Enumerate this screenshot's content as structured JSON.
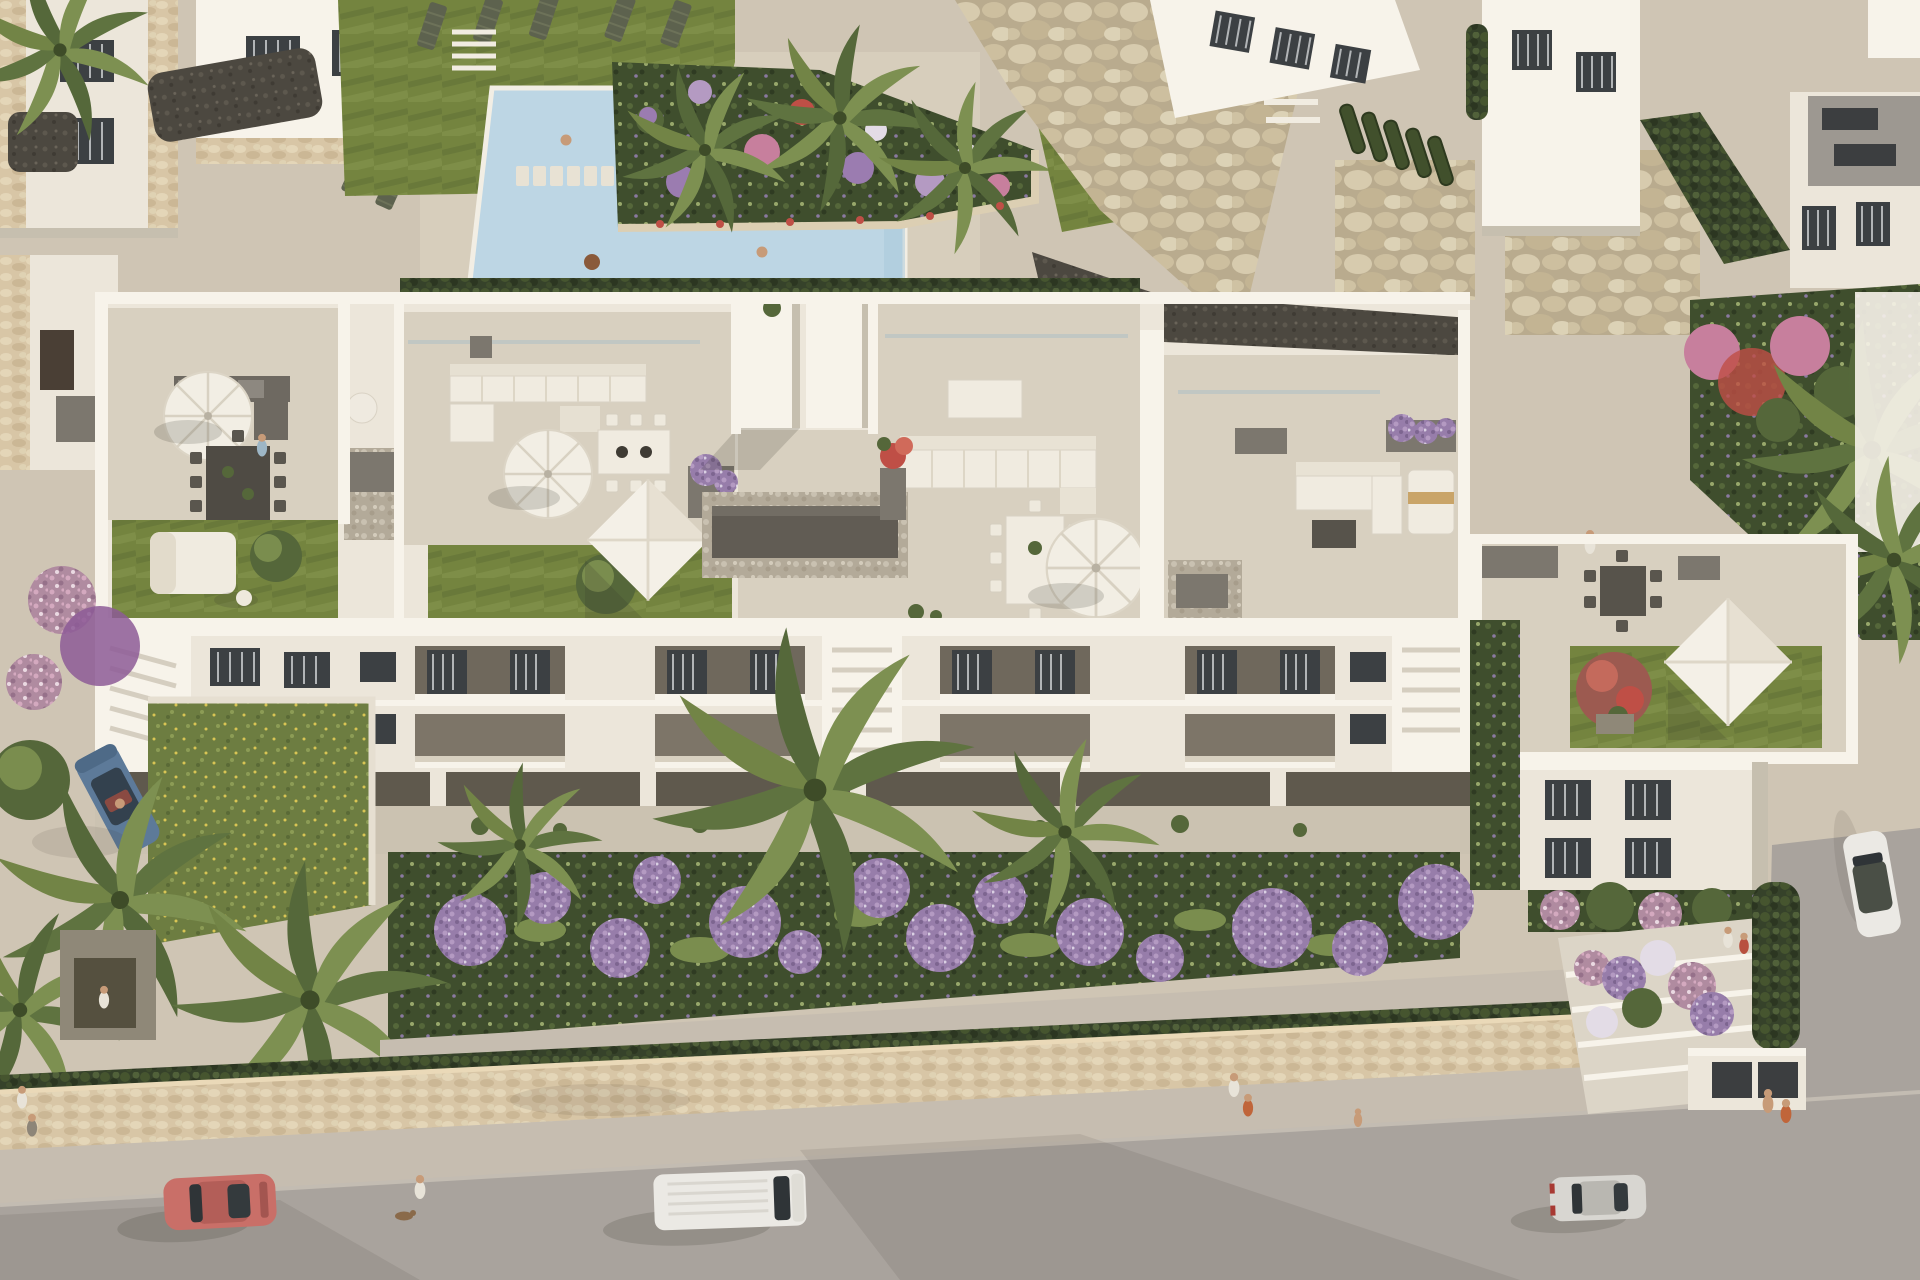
{
  "meta": {
    "label": "Aerial 3D render of a white Mediterranean apartment complex with rooftop terraces, communal pool, gardens and a street with cars"
  },
  "palette": {
    "plaza": "#cfc5b4",
    "plazaShade": "#c1b6a4",
    "tile": "#d8d0c0",
    "tileShade": "#cbc2b1",
    "whiteHi": "#f7f3ea",
    "whiteMid": "#ece6da",
    "whiteLo": "#dcd5c7",
    "wallShade": "#c6bfaf",
    "street": "#a9a39d",
    "sidewalk": "#c6bdb0",
    "stoneWall": "#d2c0a0",
    "pool": "#bdd6e4",
    "poolDeep": "#a8c8da",
    "lawn": "#74843f",
    "lawnDark": "#5d6e33",
    "vegDark": "#39452a",
    "vegMid": "#55673a",
    "vegLight": "#7a8d4e",
    "flowerPurple": "#9b7cb0",
    "flowerPink": "#c77f9d",
    "flowerRed": "#bf4f46",
    "flowerWhite": "#e3dce6",
    "gravelDark": "#4c4840",
    "pebble": "#b3aa99",
    "furnDark": "#57534b",
    "furnGray": "#7c776e",
    "cushion": "#f0ebe0",
    "woodTan": "#cdb593",
    "carRed": "#c96f68",
    "carBlue": "#5d7a99",
    "carWhite": "#ebe9e4",
    "carSilver": "#d8d6d1",
    "skin": "#c79b78",
    "shadow": "#3a352c"
  },
  "scene": {
    "setting": "aerial view of a Mediterranean-style white residential complex at golden hour",
    "features": [
      "communal swimming pool",
      "sun deck with loungers",
      "flower planters with banana palms",
      "river-stone retaining walls",
      "rooftop terraces with artificial lawns",
      "square shade sails",
      "round white parasols",
      "outdoor lounge and dining furniture",
      "gravel roof patches with storage boxes",
      "street with parked and passing cars",
      "pedestrians and a dog",
      "palm trees",
      "lavender ball shrubs",
      "bougainvillea",
      "entrance stairs with flower terraces"
    ],
    "vehicles": [
      {
        "name": "blue-convertible",
        "color": "#5d7a99",
        "location": "left driveway"
      },
      {
        "name": "red-coupe",
        "color": "#c96f68",
        "location": "street left"
      },
      {
        "name": "white-van",
        "color": "#ebe9e4",
        "location": "street center"
      },
      {
        "name": "silver-hatchback",
        "color": "#d8d6d1",
        "location": "street right"
      },
      {
        "name": "white-parked-car",
        "color": "#ebe9e4",
        "location": "right driveway"
      }
    ],
    "counts": {
      "rooftopTerraces": 5,
      "roundParasols": 4,
      "shadeSails": 3,
      "swimmingPools": 1,
      "streetVehicles": 3,
      "parkedVehicles": 2
    }
  }
}
